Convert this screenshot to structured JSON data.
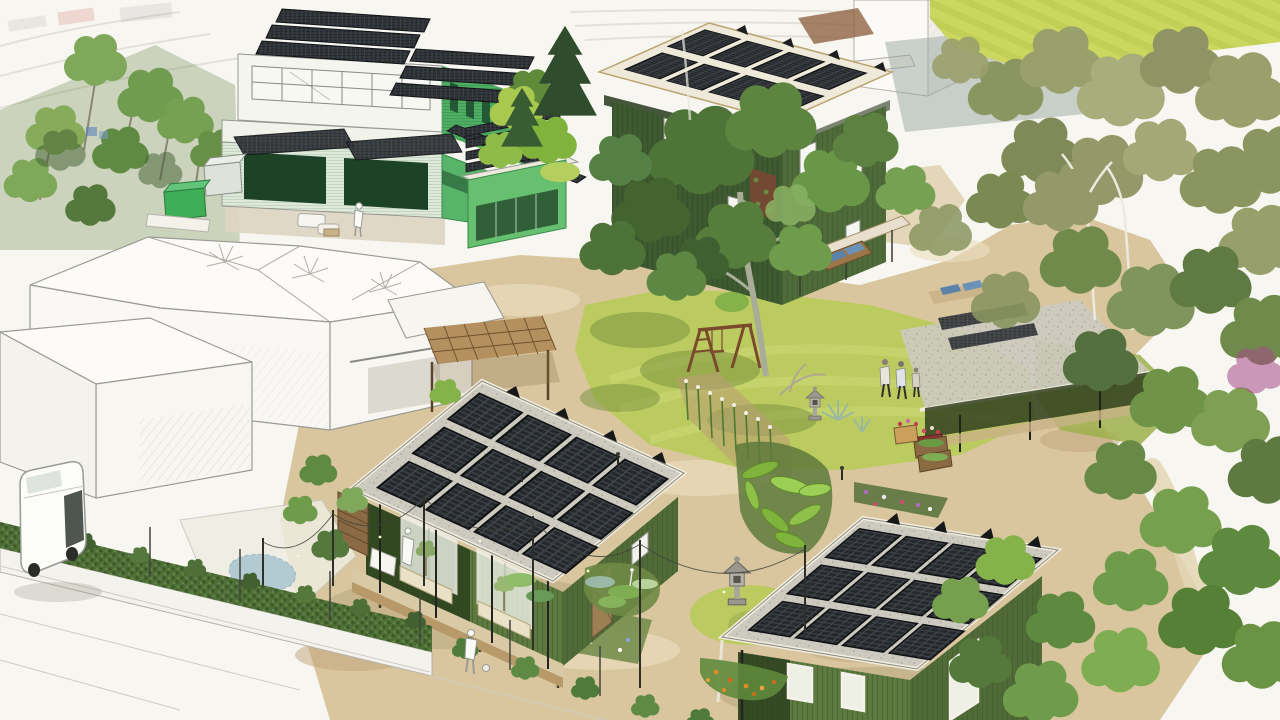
{
  "image": {
    "kind": "architectural rendering",
    "view": "aerial axonometric",
    "style": "hand-drawn sketch with selective green colorization",
    "subject": "Solar-powered eco-village courtyard community surrounded by an uncolored sketched neighborhood",
    "text_in_image": "none"
  },
  "palette": {
    "paper": "#f7f6f1",
    "sketch_line": "#9a9a94",
    "field_green": "#ccd75f",
    "lawn_bright": "#bccb5f",
    "lawn_mid": "#9db04c",
    "path_sand": "#d9c69e",
    "soil": "#b99d74",
    "building_green_light": "#66c06f",
    "building_green_mid": "#4fae63",
    "house_green_dark": "#3e5a30",
    "cabin_green": "#5d7a40",
    "hedge_green": "#4e6f38",
    "tree_dark": "#3f6030",
    "tree_mid": "#5c8140",
    "tree_light": "#86ab5a",
    "tree_olive": "#9aa06c",
    "tree_sage": "#afb183",
    "solar_panel": "#26292c",
    "roof_fascia": "#f0ebdc",
    "wood_swing": "#7a4a2c",
    "wood_pergola": "#b3905e",
    "lantern_gray": "#b5b3aa",
    "van_white": "#fcfcf9",
    "flower_red": "#c13d4a",
    "flower_orange": "#e08a2a",
    "pond_blue": "#a8c6d0"
  },
  "scene": {
    "buildings": [
      {
        "name": "community-building",
        "desc": "Two-story bright-green community building with rooftop solar clusters, two solar carport canopies over open bays, and a side solar rack array"
      },
      {
        "name": "solar-annex",
        "desc": "Small bright-green annex topped with four solar rows"
      },
      {
        "name": "north-house",
        "desc": "Two-story green house with wide overhanging flat roof carrying 8 tilted solar racks"
      },
      {
        "name": "west-cabin",
        "desc": "One-story green cabin on low stilts with front porch, planter boxes and a roof of 12 tilted solar racks"
      },
      {
        "name": "south-cabin",
        "desc": "One-story green cabin with a roof of 12 tilted solar racks"
      },
      {
        "name": "east-house",
        "desc": "Green house almost hidden under mature trees, porch with red flower planters and roof solar hints"
      },
      {
        "name": "sketch-neighborhood",
        "desc": "Uncolored line-drawn neighboring houses, pergola, pond and street at left and bottom-left"
      }
    ],
    "landscape": {
      "central_lawn": "sunlit yellow-green lawn with mowing arcs",
      "sand_paths": "winding tan gravel paths connecting all homes",
      "field": "bright mown field at top right",
      "big_tree": "large shade tree in the middle of the courtyard",
      "right_grove": "dense olive-green canopy with white birch trunks hiding the east house",
      "gardens": [
        "hollyhock flower rows",
        "hosta bed",
        "large-leaf tropical bed",
        "blue flower bed",
        "orange flower bed",
        "purple flower plot",
        "raised timber beds"
      ],
      "pond": "small blue pond beside the sketched house",
      "hedge": "clipped hedge on a low wall separating the village from the street"
    },
    "features": [
      "wooden swing set",
      "two stone lanterns",
      "timber pergola",
      "string lights on posts",
      "white deck sofas",
      "wooden bench with blue cushions",
      "green storage containers",
      "blue recycling bins"
    ],
    "figures": {
      "walking_on_east_path": 3,
      "on_west_cabin_deck": 1,
      "on_community_patio": 1,
      "by_street_with_ball": 1
    },
    "vehicles": [
      {
        "name": "white-van",
        "desc": "White van parked on the street outside the hedge"
      }
    ]
  }
}
